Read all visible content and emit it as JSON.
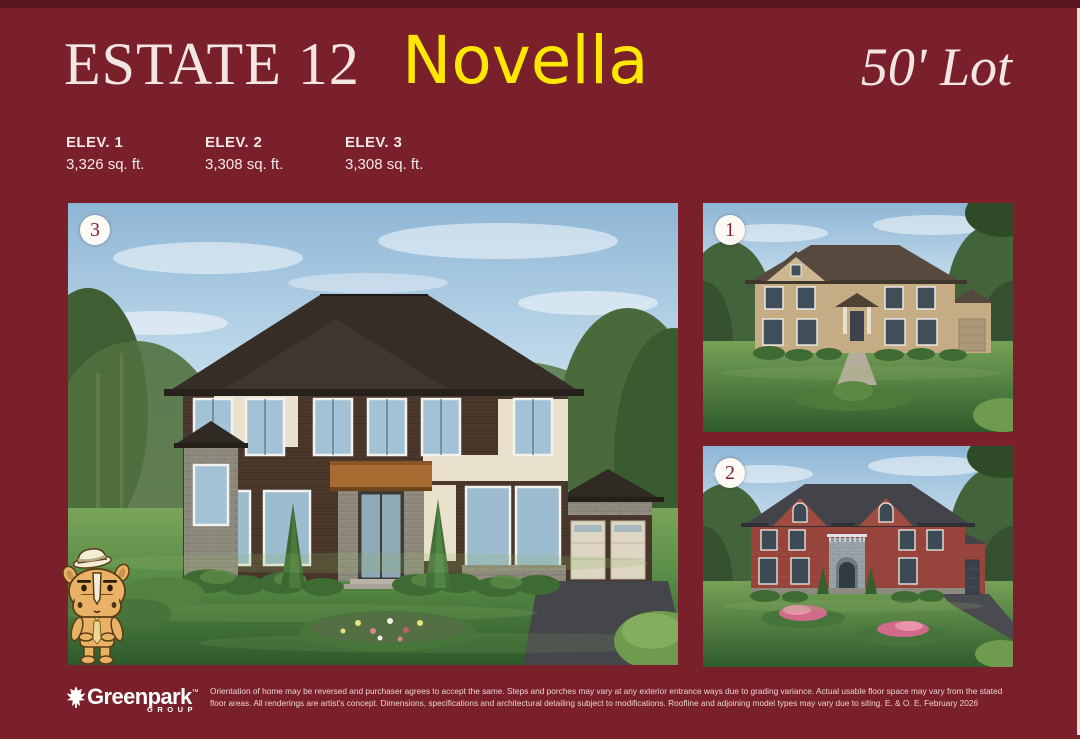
{
  "header": {
    "series_title": "ESTATE 12",
    "model_name": "Novella",
    "lot_label": "50' Lot"
  },
  "elevations": [
    {
      "label": "ELEV. 1",
      "area": "3,326 sq. ft."
    },
    {
      "label": "ELEV. 2",
      "area": "3,308 sq. ft."
    },
    {
      "label": "ELEV. 3",
      "area": "3,308 sq. ft."
    }
  ],
  "renderings": {
    "main": {
      "badge": "3",
      "description": "Elevation 3 exterior rendering - modern two-storey home, dark brick with cream stucco and stone accents, double garage"
    },
    "top_right": {
      "badge": "1",
      "description": "Elevation 1 exterior rendering - traditional tan brick two-storey home"
    },
    "bottom_right": {
      "badge": "2",
      "description": "Elevation 2 exterior rendering - red brick two-storey home with grey stone centre entry"
    }
  },
  "mascot": {
    "description": "Greenpark rhino mascot wearing fedora hat and tie"
  },
  "footer": {
    "brand": "Greenpark",
    "brand_tm": "™",
    "brand_sub": "GROUP",
    "disclaimer_lines": [
      "Orientation of home may be reversed and purchaser agrees to accept the same. Steps and porches may vary at any exterior entrance ways due to grading variance. Actual usable floor space may vary from the stated",
      "floor areas. All renderings are artist's concept. Dimensions, specifications and architectural detailing subject to modifications. Roofline and adjoining model types may vary due to siting. E. & O. E. February 2026"
    ]
  },
  "icons": {
    "brand_leaf": "maple-leaf"
  },
  "colors": {
    "background": "#7a202b",
    "top_band": "#5a161f",
    "edge_strip": "#f0dce0",
    "accent_yellow": "#ffe800",
    "title_cream": "#f3e6e2",
    "badge_bg": "#fdfaf5",
    "badge_text": "#7d2231"
  }
}
